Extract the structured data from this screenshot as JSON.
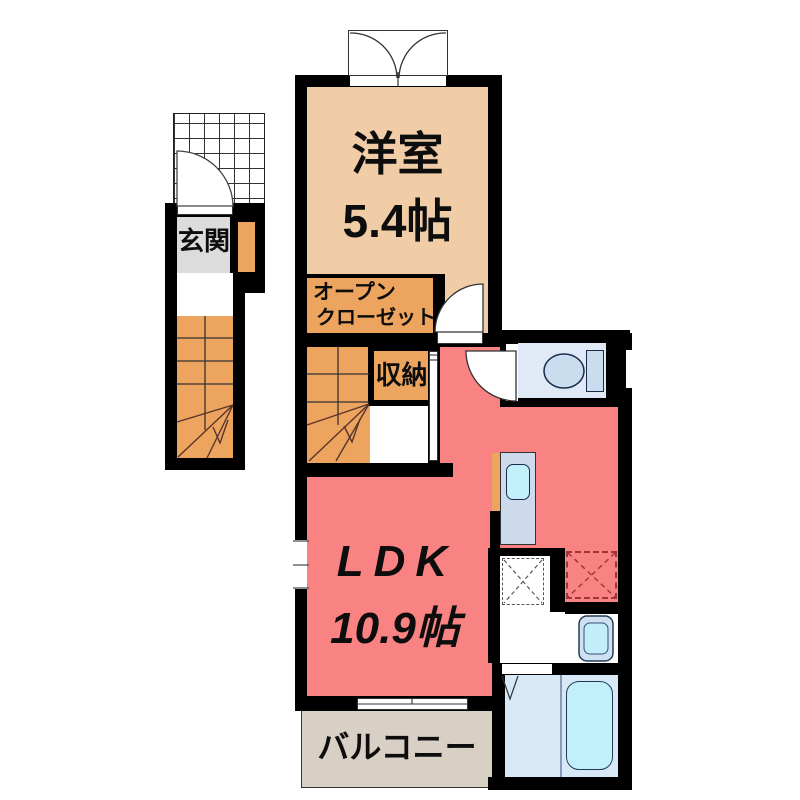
{
  "plan": {
    "title": "apartment floor plan",
    "rooms": {
      "western_room": {
        "label": "洋室",
        "size": "5.4帖"
      },
      "open_closet": {
        "label_line1": "オープン",
        "label_line2": "クローゼット"
      },
      "storage": {
        "label": "収納"
      },
      "entrance": {
        "label": "玄関"
      },
      "ldk": {
        "label": "LDK",
        "size": "10.9帖"
      },
      "balcony": {
        "label": "バルコニー"
      }
    },
    "fixtures": [
      "toilet",
      "kitchen-counter",
      "kitchen-sink",
      "washbasin",
      "bathtub",
      "washing-machine-space",
      "refrigerator-space",
      "exterior-staircase",
      "interior-staircase",
      "entrance-porch",
      "shoe-cabinet",
      "french-doors",
      "sliding-window",
      "swing-doors",
      "folding-door"
    ],
    "colors": {
      "wall": "#000000",
      "western_room": "#f0cda6",
      "closet_storage_stairs": "#eca45f",
      "ldk": "#f98282",
      "entrance": "#dcdcdc",
      "balcony": "#d8d0c4",
      "water_rooms": "#dfeaf6",
      "tub_sink": "#c2f0fa"
    }
  }
}
